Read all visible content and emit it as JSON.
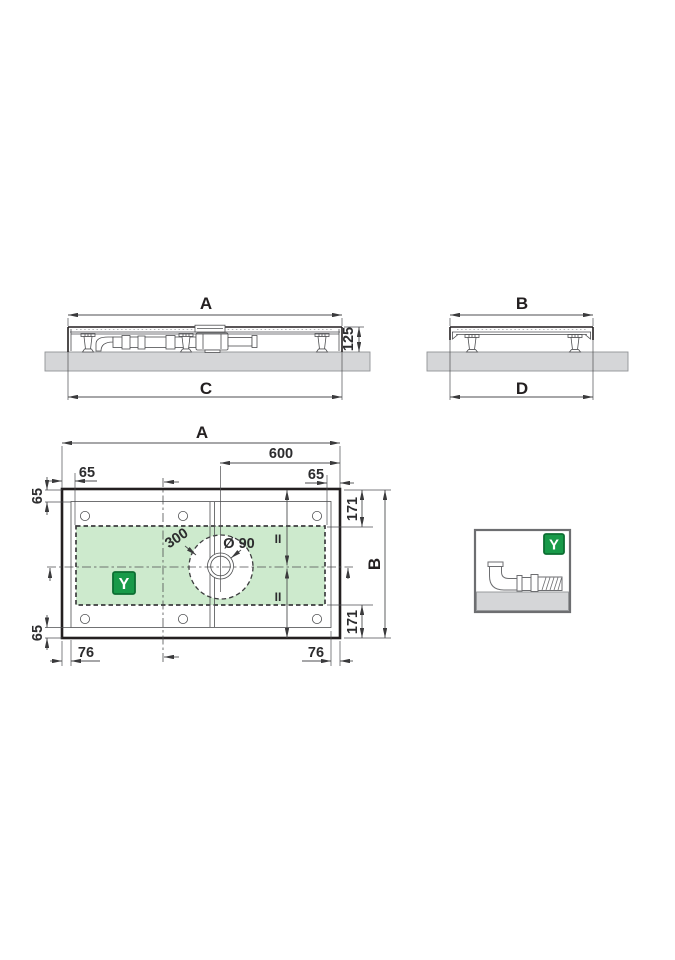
{
  "views": {
    "side_long": {
      "width_label": "A",
      "depth_label": "C",
      "height_label": "125"
    },
    "side_short": {
      "width_label": "B",
      "depth_label": "D"
    },
    "plan": {
      "width_label": "A",
      "height_label": "B",
      "drain_to_edge": "600",
      "edge_offset": "65",
      "corner_offset": "171",
      "foot_offset": "76",
      "zone_diameter": "300",
      "drain_diameter": "Ø 90",
      "equal_mark": "II",
      "zone_badge": "Y"
    },
    "legend": {
      "badge": "Y"
    }
  },
  "colors": {
    "line_dark": "#231f20",
    "line_gray": "#4d4e50",
    "zone_green_fill": "#cdeacd",
    "badge_green": "#189a49",
    "badge_border": "#0c6e32",
    "floor_gray": "#d5d6d8"
  }
}
